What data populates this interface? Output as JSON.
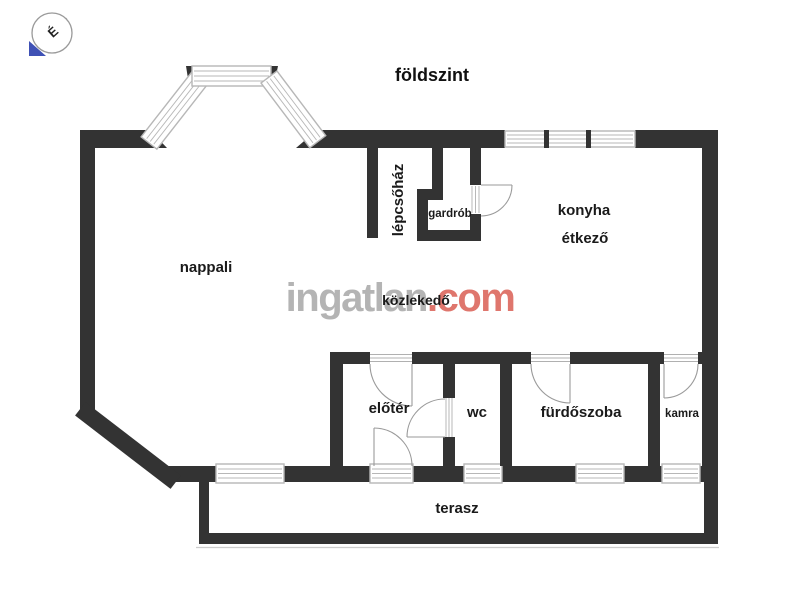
{
  "title": {
    "text": "földszint"
  },
  "compass": {
    "letter": "É",
    "arrow_color": "#3f51b5"
  },
  "watermark": {
    "name": "ingatlan",
    "tld": ".com",
    "name_color": "#b4b4b4",
    "tld_color": "#df766d"
  },
  "rooms": {
    "nappali": {
      "label": "nappali"
    },
    "lepcsohaz": {
      "label": "lépcsőház"
    },
    "gardrob": {
      "label": "gardrób"
    },
    "konyha": {
      "label": "konyha"
    },
    "etkezo": {
      "label": "étkező"
    },
    "kozlekedo": {
      "label": "közlekedő"
    },
    "eloter": {
      "label": "előtér"
    },
    "wc": {
      "label": "wc"
    },
    "furdoszoba": {
      "label": "fürdőszoba"
    },
    "kamra": {
      "label": "kamra"
    },
    "terasz": {
      "label": "terasz"
    }
  },
  "colors": {
    "wall": "#333333",
    "window_frame": "#b7b7b7",
    "door_arc": "#9a9a9a",
    "label": "#1a1a1a"
  }
}
